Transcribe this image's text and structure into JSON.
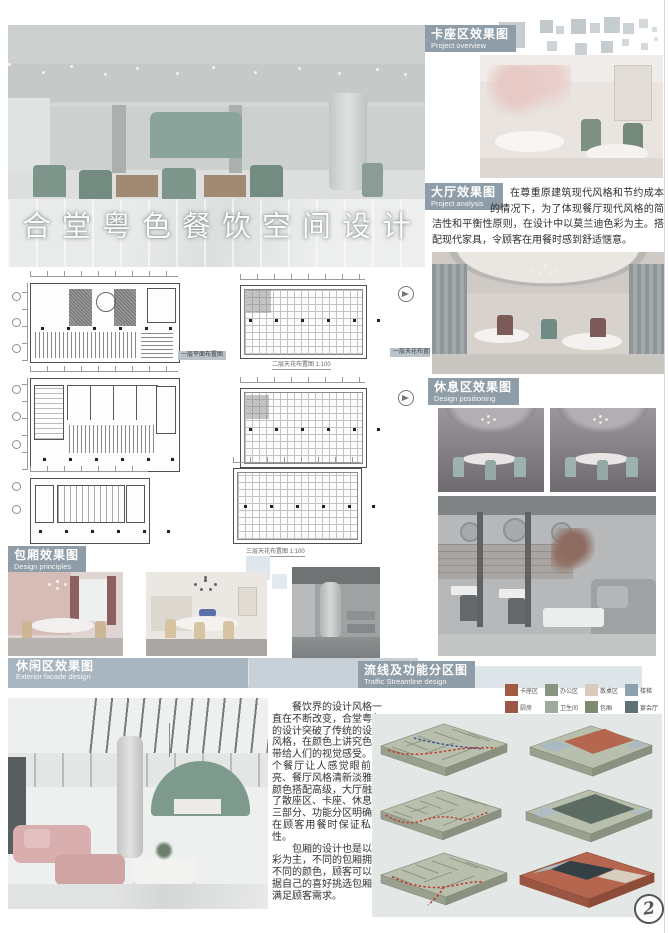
{
  "poster": {
    "title": "合堂粤色餐饮空间设计",
    "watermark": "2"
  },
  "sections": {
    "kazuo": {
      "zh": "卡座区效果图",
      "en": "Project overview"
    },
    "dating": {
      "zh": "大厅效果图",
      "en": "Project analysis"
    },
    "xiuxi": {
      "zh": "休息区效果图",
      "en": "Design positioning"
    },
    "baoxiang": {
      "zh": "包厢效果图",
      "en": "Design principles"
    },
    "xiuxian": {
      "zh": "休闲区效果图",
      "en": "Exterior facade design"
    },
    "liuxian": {
      "zh": "流线及功能分区图",
      "en": "Traffic Streamline design"
    }
  },
  "paragraphs": {
    "hall": "在尊重原建筑现代风格和节约成本的情况下，为了体现餐厅现代风格的简洁性和平衡性原则，在设计中以莫兰迪色彩为主。搭配现代家具，令顾客在用餐时感到舒适惬意。",
    "main_1": "餐饮界的设计风格一直在不断改变，合堂粤色的设计突破了传统的设计风格，在颜色上讲究色彩带给人们的视觉感受。整个餐厅让人感觉眼前一亮、餐厅风格清新淡雅、颜色搭配高级，大厅融合了散座区、卡座、休息区三部分、功能分区明确，在顾客用餐时保证私密性。",
    "main_2": "包厢的设计也是以色彩为主，不同的包厢拥有不同的颜色，顾客可以根据自己的喜好挑选包厢，满足顾客需求。"
  },
  "legend": {
    "items": [
      {
        "label": "卡座区",
        "color": "#a25a43"
      },
      {
        "label": "办公区",
        "color": "#87947f"
      },
      {
        "label": "散桌区",
        "color": "#d9cabe"
      },
      {
        "label": "楼梯",
        "color": "#8ba1ad"
      },
      {
        "label": "厨房",
        "color": "#9c5847"
      },
      {
        "label": "卫生间",
        "color": "#9fab9f"
      },
      {
        "label": "包厢",
        "color": "#7b8d6e"
      },
      {
        "label": "宴会厅",
        "color": "#5e7173"
      }
    ]
  },
  "plans": {
    "captions": [
      "一层平面布置图",
      "一层天花布置图",
      "二层天花布置图 1:100",
      "三层天花布置图 1:100"
    ]
  },
  "colors": {
    "section_label_bg": "#8e9da8",
    "leisure_bar_bg": "#a7b6c0",
    "zone_red": "#b4674e",
    "zone_dark": "#343f46",
    "plate_green": "#b8bfad",
    "flow_red": "#c23a2c",
    "flow_blue": "#3c4f9e"
  }
}
